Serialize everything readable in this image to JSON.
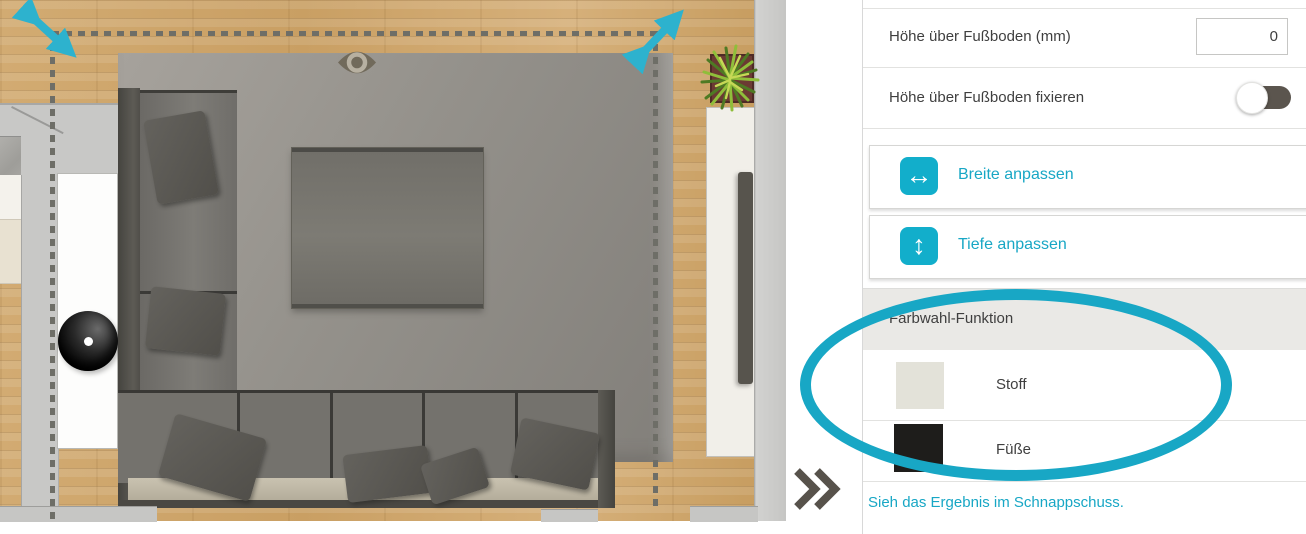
{
  "accent_teal": "#18a7c5",
  "panel": {
    "height_row": {
      "label": "Höhe über Fußboden (mm)",
      "value": "0"
    },
    "fix_row": {
      "label": "Höhe über Fußboden fixieren",
      "toggle_state": "off"
    },
    "buttons": [
      {
        "label": "Breite anpassen",
        "glyph": "↔",
        "icon": "width-adjust-icon"
      },
      {
        "label": "Tiefe anpassen",
        "glyph": "↕",
        "icon": "depth-adjust-icon"
      }
    ],
    "color_section": {
      "header": "Farbwahl-Funktion",
      "swatches": [
        {
          "label": "Stoff",
          "color": "#e3e2d9"
        },
        {
          "label": "Füße",
          "color": "#1e1d1b"
        }
      ]
    },
    "snapshot_link": "Sieh das Ergebnis im Schnappschuss."
  },
  "room": {
    "floor_color": "#cda46a",
    "rug_color": "#8d8a85",
    "sofa_color": "#6f6d69",
    "selection_color": "#6e6e67",
    "handle_color": "#2db2ce"
  }
}
